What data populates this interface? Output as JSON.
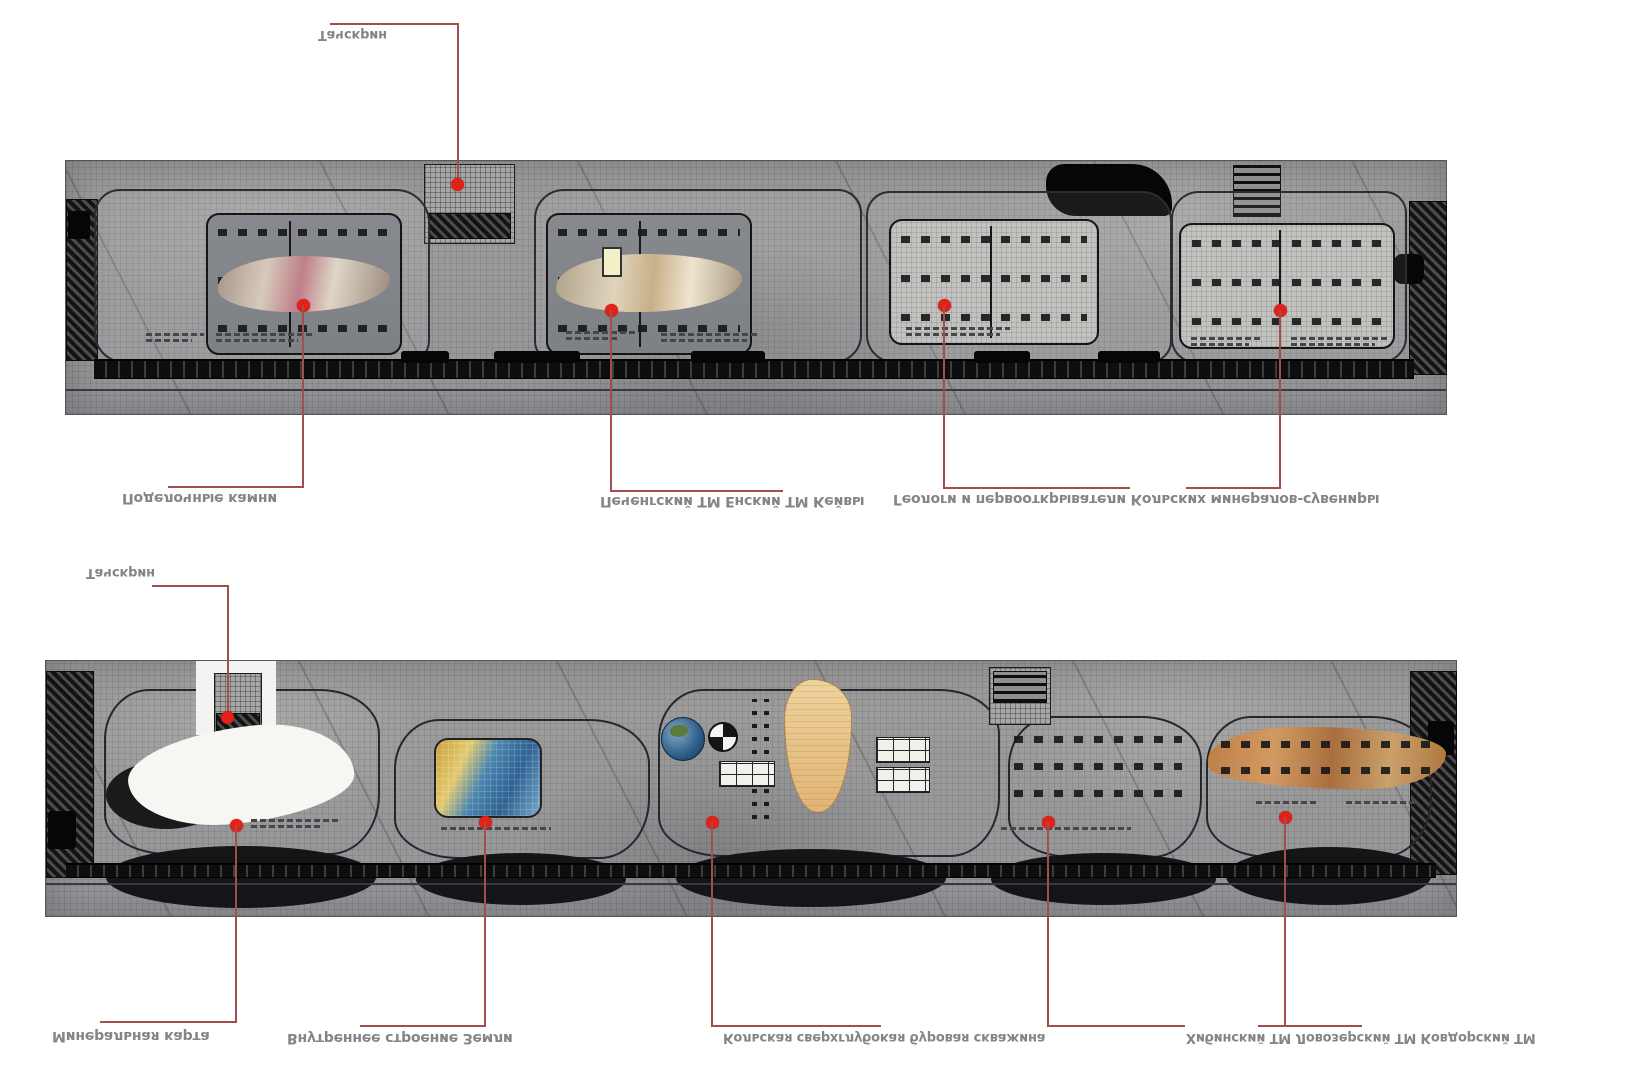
{
  "colors": {
    "background": "#ffffff",
    "marker_red": "#e2211a",
    "leader_line": "#a24f4b",
    "label_text": "#858585",
    "slab_gray": "#9b9b99",
    "wall_dark": "#151517",
    "tan_exhibit": "#e7c288",
    "orange_exhibit": "#bd7c46",
    "photo_blue": "#2f6292",
    "photo_sand": "#d9a73f"
  },
  "labels": {
    "top_strip": {
      "touchscreen": "Тачскрин",
      "hall1": "Поделочные камни",
      "hall2": "Печенгский ТМ Енский ТМ Кейвы",
      "halls34": "Геологи и первооткрыватели Кольских минералов-сувениры"
    },
    "bottom_strip": {
      "touchscreen": "Тачскрин",
      "zone1": "Минеральная карта",
      "zone2": "Внутреннее строение Земли",
      "zone3": "Кольская сверхглубокая буровая скважина",
      "zone4": "Хибинский ТМ Ловозерский ТМ Ковдорский ТМ"
    }
  }
}
